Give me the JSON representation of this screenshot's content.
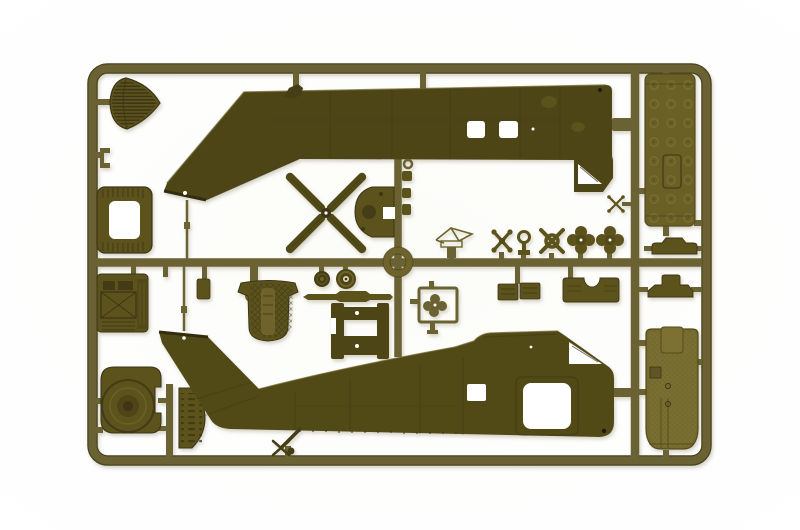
{
  "scene": {
    "description": "Photograph of an olive drab injection-moulded plastic model kit sprue containing two helicopter fuselage halves, tail rotor, rotor hub parts, seats, wheels, panels and small detail parts on a white background",
    "background_color": "#ffffff"
  },
  "palette": {
    "bg": "#ffffff",
    "runner": "#6b6231",
    "runnerDark": "#4a431c",
    "plasticDark": "#4d4517",
    "plasticDark2": "#514919",
    "plasticMid": "#5c531f",
    "plasticLight": "#6e6429",
    "panelTop": "#6b6128",
    "panelBottom": "#746a2e",
    "texDark": "#3c3513",
    "highlight": "#847a3c",
    "paper": "#ffffff",
    "shadow": "#9a9478"
  },
  "sprue": {
    "frame": {
      "label": "rounded rectangular sprue frame with centre runners"
    },
    "parts": [
      {
        "id": "nose-cone",
        "label": "ribbed nose cone / intake screen"
      },
      {
        "id": "clip-bracket",
        "label": "small C bracket"
      },
      {
        "id": "door-frame",
        "label": "rectangular door frame with opening"
      },
      {
        "id": "instrument-console",
        "label": "instrument console with cross brace"
      },
      {
        "id": "dome-panel",
        "label": "rounded panel with concentric dome"
      },
      {
        "id": "grille-half",
        "label": "half-oval slotted grille"
      },
      {
        "id": "upper-fuselage-half",
        "label": "right fuselage half, inverted, with two window openings"
      },
      {
        "id": "tail-rotor",
        "label": "four-blade tail rotor"
      },
      {
        "id": "gearbox-housing",
        "label": "D-shaped gearbox housing"
      },
      {
        "id": "knob-parts",
        "label": "three small knob parts and eyelet"
      },
      {
        "id": "center-ring",
        "label": "circular ring part at runner crossing"
      },
      {
        "id": "washer-ring",
        "label": "small washer ring"
      },
      {
        "id": "mirror-flag",
        "label": "small flat tab part"
      },
      {
        "id": "wheel-small",
        "label": "small tail wheel"
      },
      {
        "id": "wheel-main",
        "label": "main wheel with hub"
      },
      {
        "id": "axle-rod",
        "label": "axle rod"
      },
      {
        "id": "engine-mount",
        "label": "H-shaped engine mount"
      },
      {
        "id": "clover-frame",
        "label": "square frame with cloverleaf part"
      },
      {
        "id": "crew-seat",
        "label": "textured crew seat with belt strap"
      },
      {
        "id": "wire-antenna",
        "label": "folded wire antenna part"
      },
      {
        "id": "scissors-link",
        "label": "scissors link"
      },
      {
        "id": "ring-post",
        "label": "eyelet on post"
      },
      {
        "id": "x-ring-hub",
        "label": "x-shaped hub with ring centre"
      },
      {
        "id": "clover-hub-a",
        "label": "four-lobed rotor hub"
      },
      {
        "id": "clover-hub-b",
        "label": "four-lobed rotor hub"
      },
      {
        "id": "mini-x-link",
        "label": "small x link"
      },
      {
        "id": "panel-pair",
        "label": "pair of small panels"
      },
      {
        "id": "arched-panel",
        "label": "wide panel with arched notch"
      },
      {
        "id": "rivet-panel",
        "label": "long riveted cabin panel"
      },
      {
        "id": "cowl-half-a",
        "label": "engine cowl half"
      },
      {
        "id": "cowl-half-b",
        "label": "engine cowl half"
      },
      {
        "id": "hatch-panel",
        "label": "long cross-hatched panel"
      },
      {
        "id": "lower-fuselage-half",
        "label": "left fuselage half with door window opening"
      },
      {
        "id": "tail-strut",
        "label": "tail wheel strut"
      }
    ]
  }
}
